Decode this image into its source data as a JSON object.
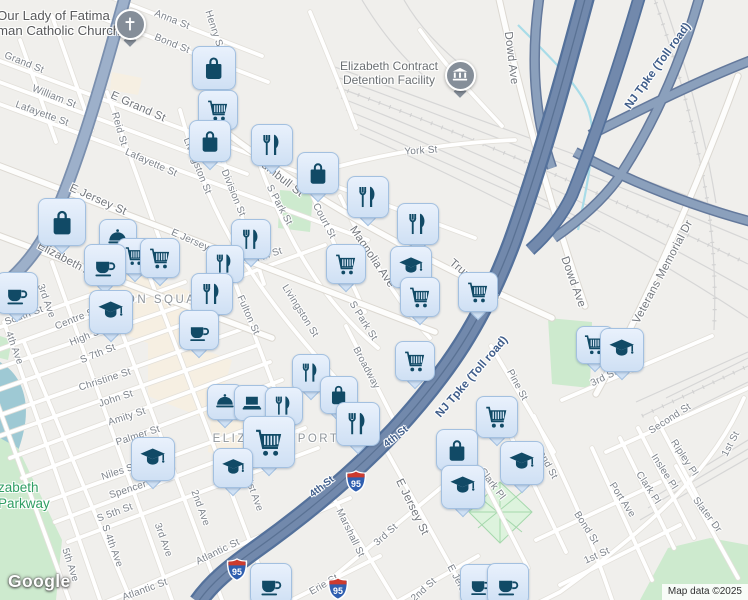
{
  "map": {
    "logo": "Google",
    "attribution": "Map data ©2025",
    "colors": {
      "background": "#f0efec",
      "road_fill": "#ffffff",
      "road_casing": "#e3e0da",
      "route19_fill": "#9db0ca",
      "turnpike_fill": "#7289ac",
      "turnpike_casing": "#54719b",
      "park_green": "#cdeace",
      "water": "#9ec9d4",
      "rail": "#d6d6d6",
      "commercial_zone": "#f6efe2",
      "pin_fill": "#d7e6f8",
      "pin_border": "#a3c0e0",
      "pin_icon": "#114a66",
      "gray_pin": "#858e99",
      "street_label": "#7d838b",
      "area_label": "#8f959b",
      "highway_label": "#3f5d8a",
      "shield_red": "#cc3b2e",
      "shield_blue": "#2f5fb0",
      "parkway_green_text": "#2f9e63"
    },
    "area_labels": [
      {
        "text": "UNION SQUARE",
        "x": 158,
        "y": 300
      },
      {
        "text": "ELIZABETHPORT",
        "x": 276,
        "y": 439
      }
    ],
    "place_labels": [
      {
        "id": "church",
        "lines": [
          "Our Lady of Fatima",
          "man Catholic Church"
        ],
        "x": -3,
        "y": 8,
        "size": 13.2,
        "color": "#58595b",
        "align": "left"
      },
      {
        "id": "detention",
        "lines": [
          "Elizabeth Contract",
          "Detention Facility"
        ],
        "x": 389,
        "y": 60,
        "size": 12,
        "color": "#6a6f72",
        "align": "center"
      },
      {
        "id": "parkway",
        "lines": [
          "zabeth",
          "Parkway"
        ],
        "x": -2,
        "y": 480,
        "size": 13.5,
        "color": "#2f9e63",
        "align": "left"
      }
    ],
    "highway_labels": [
      {
        "text": "NJ Tpke (Toll road)",
        "x": 658,
        "y": 66,
        "a": -54
      },
      {
        "text": "NJ Tpke (Toll road)",
        "x": 472,
        "y": 377,
        "a": -49
      },
      {
        "text": "4th St",
        "x": 322,
        "y": 487,
        "a": -38,
        "sm": true
      },
      {
        "text": "4th St",
        "x": 396,
        "y": 437,
        "a": -38,
        "sm": true
      }
    ],
    "shields": [
      {
        "text": "95",
        "x": 356,
        "y": 484
      },
      {
        "text": "95",
        "x": 237,
        "y": 572
      },
      {
        "text": "95",
        "x": 338,
        "y": 591
      }
    ],
    "street_labels": [
      {
        "text": "Anna St",
        "x": 172,
        "y": 20,
        "a": 22
      },
      {
        "text": "Bond St",
        "x": 172,
        "y": 44,
        "a": 22
      },
      {
        "text": "Henry St",
        "x": 214,
        "y": 30,
        "a": 72
      },
      {
        "text": "Grand St",
        "x": 24,
        "y": 63,
        "a": 22
      },
      {
        "text": "William St",
        "x": 54,
        "y": 97,
        "a": 22
      },
      {
        "text": "Lafayette St",
        "x": 42,
        "y": 114,
        "a": 20
      },
      {
        "text": "E Grand St",
        "x": 138,
        "y": 107,
        "a": 24,
        "lg": true
      },
      {
        "text": "Reid St",
        "x": 119,
        "y": 129,
        "a": 74
      },
      {
        "text": "Lafayette St",
        "x": 151,
        "y": 163,
        "a": 24
      },
      {
        "text": "Livingston St",
        "x": 197,
        "y": 166,
        "a": 68
      },
      {
        "text": "E Jersey St",
        "x": 98,
        "y": 200,
        "a": 24,
        "lg": true
      },
      {
        "text": "E Jersey St",
        "x": 196,
        "y": 243,
        "a": 24
      },
      {
        "text": "Division St",
        "x": 233,
        "y": 193,
        "a": 68
      },
      {
        "text": "Trumbull St",
        "x": 278,
        "y": 176,
        "a": 38,
        "lg": true
      },
      {
        "text": "S Park St",
        "x": 279,
        "y": 205,
        "a": 62
      },
      {
        "text": "Court St",
        "x": 324,
        "y": 221,
        "a": 62
      },
      {
        "text": "Magnolia Ave",
        "x": 372,
        "y": 257,
        "a": 56,
        "lg": true
      },
      {
        "text": "York St",
        "x": 421,
        "y": 151,
        "a": -4
      },
      {
        "text": "Dowd Ave",
        "x": 511,
        "y": 58,
        "a": 83,
        "lg": true
      },
      {
        "text": "Elizabeth Ave",
        "x": 70,
        "y": 262,
        "a": 28,
        "lg": true
      },
      {
        "text": "7th St",
        "x": 269,
        "y": 255,
        "a": -18
      },
      {
        "text": "Fulton St",
        "x": 248,
        "y": 315,
        "a": 66
      },
      {
        "text": "Livingston St",
        "x": 300,
        "y": 311,
        "a": 58
      },
      {
        "text": "S Park St",
        "x": 363,
        "y": 321,
        "a": 58
      },
      {
        "text": "Broadway",
        "x": 366,
        "y": 368,
        "a": 62
      },
      {
        "text": "3rd Ave",
        "x": 46,
        "y": 301,
        "a": 70
      },
      {
        "text": "South St",
        "x": 24,
        "y": 316,
        "a": -20
      },
      {
        "text": "4th Ave",
        "x": 14,
        "y": 348,
        "a": 70
      },
      {
        "text": "Centre St",
        "x": 76,
        "y": 319,
        "a": -22
      },
      {
        "text": "High St",
        "x": 86,
        "y": 337,
        "a": -22
      },
      {
        "text": "S 7th St",
        "x": 98,
        "y": 354,
        "a": -22
      },
      {
        "text": "Christine St",
        "x": 105,
        "y": 380,
        "a": -18
      },
      {
        "text": "John St",
        "x": 116,
        "y": 399,
        "a": -18
      },
      {
        "text": "Amity St",
        "x": 127,
        "y": 417,
        "a": -18
      },
      {
        "text": "Palmer St",
        "x": 138,
        "y": 436,
        "a": -18
      },
      {
        "text": "Niles St",
        "x": 119,
        "y": 472,
        "a": -18
      },
      {
        "text": "Spencer",
        "x": 128,
        "y": 490,
        "a": -18
      },
      {
        "text": "S 5th St",
        "x": 115,
        "y": 513,
        "a": -20
      },
      {
        "text": "S 4th Ave",
        "x": 112,
        "y": 546,
        "a": 70
      },
      {
        "text": "3rd Ave",
        "x": 163,
        "y": 540,
        "a": 70
      },
      {
        "text": "2nd Ave",
        "x": 200,
        "y": 508,
        "a": 70
      },
      {
        "text": "1st Ave",
        "x": 254,
        "y": 495,
        "a": 70
      },
      {
        "text": "5th Ave",
        "x": 70,
        "y": 565,
        "a": 72
      },
      {
        "text": "Atlantic St",
        "x": 218,
        "y": 552,
        "a": -26
      },
      {
        "text": "Atlantic St",
        "x": 145,
        "y": 590,
        "a": -20
      },
      {
        "text": "Trumbull St",
        "x": 474,
        "y": 281,
        "a": 40,
        "lg": true
      },
      {
        "text": "Pine St",
        "x": 517,
        "y": 385,
        "a": 62
      },
      {
        "text": "Dowd Ave",
        "x": 573,
        "y": 282,
        "a": 70,
        "lg": true
      },
      {
        "text": "Veterans Memorial Dr",
        "x": 663,
        "y": 272,
        "a": -62,
        "lg": true
      },
      {
        "text": "3rd St",
        "x": 604,
        "y": 378,
        "a": -26
      },
      {
        "text": "Second St",
        "x": 670,
        "y": 419,
        "a": -33
      },
      {
        "text": "Ripley Pl",
        "x": 684,
        "y": 458,
        "a": 57
      },
      {
        "text": "Inslee Pl",
        "x": 664,
        "y": 472,
        "a": 57
      },
      {
        "text": "Clark Pl",
        "x": 648,
        "y": 488,
        "a": 57
      },
      {
        "text": "Port Ave",
        "x": 622,
        "y": 500,
        "a": 57
      },
      {
        "text": "1st St",
        "x": 731,
        "y": 444,
        "a": -62
      },
      {
        "text": "Slater Dr",
        "x": 707,
        "y": 515,
        "a": 53
      },
      {
        "text": "Bond St",
        "x": 546,
        "y": 462,
        "a": 62
      },
      {
        "text": "Bond St",
        "x": 586,
        "y": 528,
        "a": 57
      },
      {
        "text": "1st St",
        "x": 597,
        "y": 556,
        "a": -24
      },
      {
        "text": "Clark Pl",
        "x": 492,
        "y": 484,
        "a": 53
      },
      {
        "text": "Marshall St",
        "x": 350,
        "y": 533,
        "a": 64
      },
      {
        "text": "3rd St",
        "x": 386,
        "y": 535,
        "a": -42
      },
      {
        "text": "Erie St",
        "x": 324,
        "y": 585,
        "a": -30
      },
      {
        "text": "2nd St",
        "x": 424,
        "y": 590,
        "a": -42
      },
      {
        "text": "E Jersey St",
        "x": 412,
        "y": 507,
        "a": 64,
        "lg": true
      },
      {
        "text": "E Jersey St",
        "x": 462,
        "y": 589,
        "a": 62
      }
    ],
    "markers": [
      {
        "t": "bag",
        "x": 213,
        "y": 67,
        "s": 42
      },
      {
        "t": "cart",
        "x": 217,
        "y": 109,
        "s": 38
      },
      {
        "t": "bag",
        "x": 209,
        "y": 140,
        "s": 40
      },
      {
        "t": "restaurant",
        "x": 271,
        "y": 144,
        "s": 40
      },
      {
        "t": "bag",
        "x": 317,
        "y": 172,
        "s": 40
      },
      {
        "t": "restaurant",
        "x": 367,
        "y": 196,
        "s": 40
      },
      {
        "t": "restaurant",
        "x": 417,
        "y": 223,
        "s": 40
      },
      {
        "t": "cart",
        "x": 345,
        "y": 263,
        "s": 38
      },
      {
        "t": "school",
        "x": 410,
        "y": 266,
        "s": 40
      },
      {
        "t": "cart",
        "x": 419,
        "y": 296,
        "s": 38
      },
      {
        "t": "cart",
        "x": 477,
        "y": 291,
        "s": 38
      },
      {
        "t": "cart",
        "x": 414,
        "y": 360,
        "s": 38
      },
      {
        "t": "cloche",
        "x": 117,
        "y": 237,
        "s": 36
      },
      {
        "t": "cart",
        "x": 134,
        "y": 255,
        "s": 34
      },
      {
        "t": "cart",
        "x": 159,
        "y": 257,
        "s": 38
      },
      {
        "t": "coffee",
        "x": 104,
        "y": 264,
        "s": 40
      },
      {
        "t": "bag",
        "x": 61,
        "y": 221,
        "s": 46
      },
      {
        "t": "coffee",
        "x": 16,
        "y": 292,
        "s": 40
      },
      {
        "t": "school",
        "x": 110,
        "y": 311,
        "s": 42
      },
      {
        "t": "restaurant",
        "x": 250,
        "y": 238,
        "s": 38
      },
      {
        "t": "restaurant",
        "x": 224,
        "y": 263,
        "s": 36
      },
      {
        "t": "restaurant",
        "x": 211,
        "y": 293,
        "s": 40
      },
      {
        "t": "coffee",
        "x": 198,
        "y": 329,
        "s": 38
      },
      {
        "t": "restaurant",
        "x": 310,
        "y": 372,
        "s": 36
      },
      {
        "t": "bag",
        "x": 338,
        "y": 394,
        "s": 36
      },
      {
        "t": "cloche",
        "x": 224,
        "y": 401,
        "s": 34
      },
      {
        "t": "laptop",
        "x": 251,
        "y": 402,
        "s": 34
      },
      {
        "t": "restaurant",
        "x": 283,
        "y": 405,
        "s": 36
      },
      {
        "t": "restaurant",
        "x": 357,
        "y": 423,
        "s": 42
      },
      {
        "t": "cart",
        "x": 268,
        "y": 441,
        "s": 50
      },
      {
        "t": "school",
        "x": 232,
        "y": 467,
        "s": 38
      },
      {
        "t": "school",
        "x": 152,
        "y": 458,
        "s": 42
      },
      {
        "t": "cart",
        "x": 496,
        "y": 416,
        "s": 40
      },
      {
        "t": "bag",
        "x": 456,
        "y": 449,
        "s": 40
      },
      {
        "t": "school",
        "x": 462,
        "y": 486,
        "s": 42
      },
      {
        "t": "school",
        "x": 521,
        "y": 462,
        "s": 42
      },
      {
        "t": "cart",
        "x": 594,
        "y": 344,
        "s": 36
      },
      {
        "t": "school",
        "x": 621,
        "y": 349,
        "s": 42
      },
      {
        "t": "coffee",
        "x": 270,
        "y": 583,
        "s": 40
      },
      {
        "t": "coffee",
        "x": 479,
        "y": 583,
        "s": 38
      },
      {
        "t": "coffee",
        "x": 507,
        "y": 583,
        "s": 40
      }
    ],
    "special_markers": [
      {
        "t": "church",
        "x": 128,
        "y": 22,
        "s": 27
      },
      {
        "t": "government",
        "x": 458,
        "y": 73,
        "s": 27
      }
    ]
  }
}
